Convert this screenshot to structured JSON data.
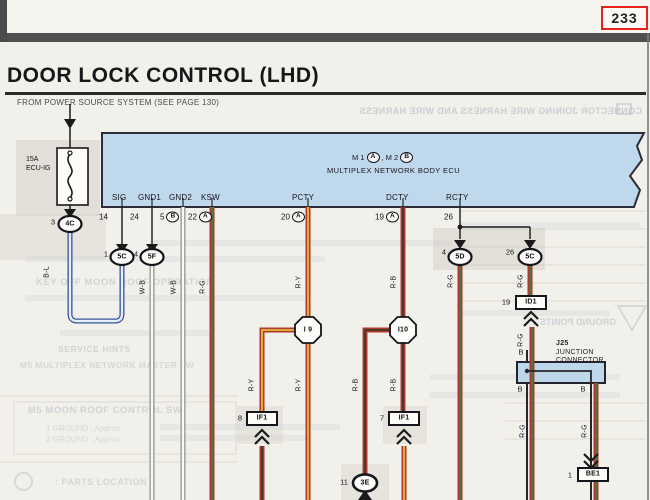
{
  "page_number": "233",
  "title": "DOOR LOCK CONTROL (LHD)",
  "subtitle": "FROM POWER SOURCE SYSTEM (SEE PAGE 130)",
  "colors": {
    "highlight_red": "#e8211d",
    "ecu_blue": "#c0d8ec",
    "wire_red": "#b0382c",
    "wire_yellow": "#e2bd3a",
    "wire_green": "#427c42",
    "wire_blue": "#33549e",
    "wire_white": "#faf9f5",
    "wire_black": "#42372f"
  },
  "fuse": {
    "rating": "15A",
    "name": "ECU-IG"
  },
  "ecu": {
    "header_m1": "M 1",
    "header_a": "A",
    "header_sep": ", M 2",
    "header_b": "B",
    "name": "MULTIPLEX NETWORK BODY ECU",
    "pins": [
      {
        "name": "SIG",
        "number": "14",
        "connector": ""
      },
      {
        "name": "GND1",
        "number": "24",
        "connector": ""
      },
      {
        "name": "GND2",
        "number": "5",
        "connector": "B"
      },
      {
        "name": "KSW",
        "number": "22",
        "connector": "A"
      },
      {
        "name": "PCTY",
        "number": "20",
        "connector": "A"
      },
      {
        "name": "DCTY",
        "number": "19",
        "connector": "A"
      },
      {
        "name": "RCTY",
        "number": "26",
        "connector": ""
      }
    ]
  },
  "connectors": {
    "c4c": {
      "number": "3",
      "code": "4C"
    },
    "c5c_sig": {
      "number": "1",
      "code": "5C"
    },
    "c5f": {
      "number": "4",
      "code": "5F"
    },
    "c5d": {
      "number": "4",
      "code": "5D"
    },
    "c5c_rcty": {
      "number": "26",
      "code": "5C"
    },
    "if1_left": {
      "number": "8",
      "code": "IF1"
    },
    "if1_right": {
      "number": "7",
      "code": "IF1"
    },
    "id1": {
      "number": "19",
      "code": "ID1"
    },
    "c3e": {
      "number": "11",
      "code": "3E"
    },
    "be1": {
      "number": "1",
      "code": "BE1"
    }
  },
  "nodes": {
    "i9": "I 9",
    "i10": "I10"
  },
  "junction_connector": {
    "id": "J25",
    "line1": "JUNCTION",
    "line2": "CONNECTOR"
  },
  "wire_labels": {
    "bl": "B-L",
    "wb1": "W-B",
    "wb2": "W-B",
    "rg_ksw": "R-G",
    "ry_pcty": "R-Y",
    "ry_i9_branch": "R-Y",
    "ry_i9_main": "R-Y",
    "rb_dcty": "R-B",
    "rb_i10_branch": "R-B",
    "rb_i10_main": "R-B",
    "rg_5d": "R-G",
    "rg_5c": "R-G",
    "rg_id1": "R-G",
    "b_top": "B",
    "b_left": "B",
    "b_right": "B",
    "rg_j25_left": "R-G",
    "rg_j25_right": "R-G"
  },
  "bleedthrough": {
    "mirrored_header": "CONNECTOR JOINING WIRE HARNESS AND WIRE HARNESS",
    "mirrored_ground": "GROUND POINTS",
    "key_off": "KEY OFF MOON ROOF OPERATION",
    "service_hints": "SERVICE HINTS",
    "master_sw": "M5 MULTIPLEX NETWORK MASTER SW",
    "moon_roof_sw": "M5 MOON ROOF CONTROL SW",
    "ground1": "1  GROUND : Approx.",
    "ground2": "2  GROUND : Approx.",
    "parts_location": ": PARTS LOCATION"
  }
}
